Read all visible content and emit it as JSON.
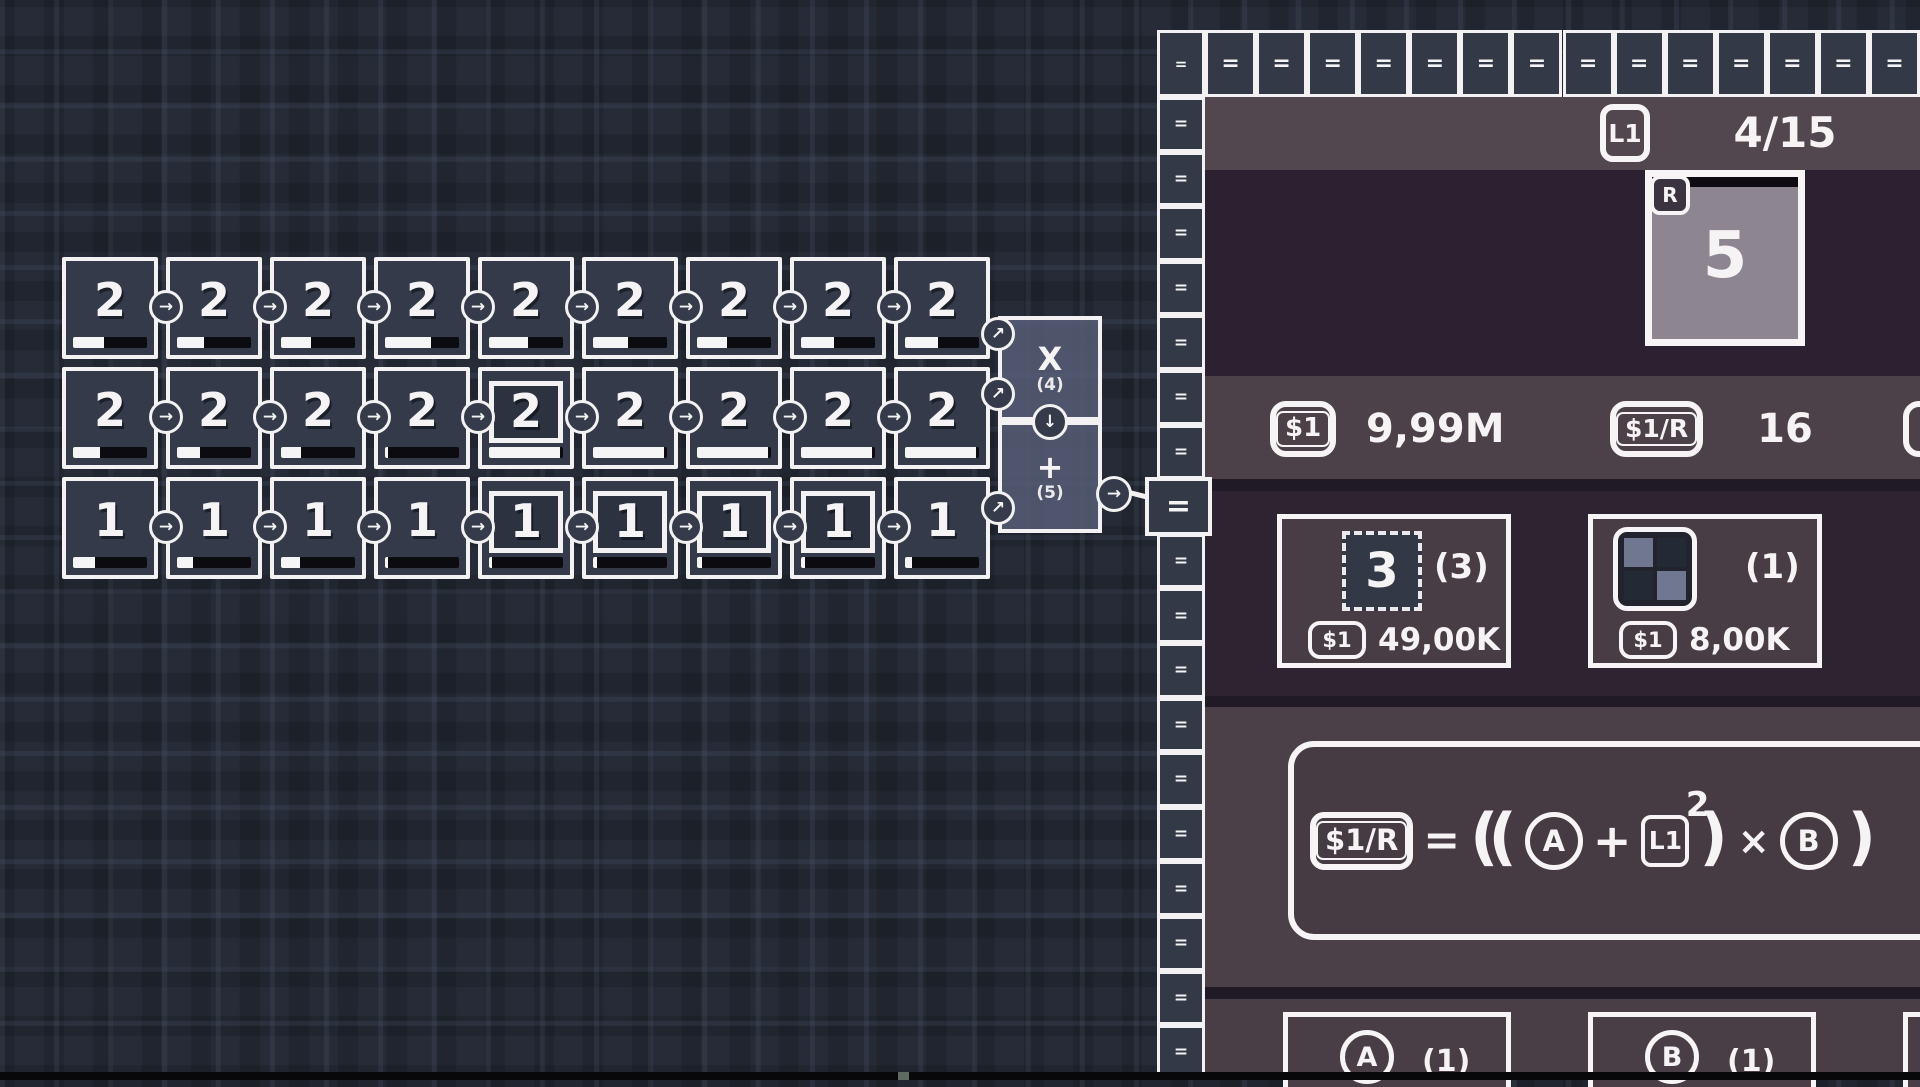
{
  "colors": {
    "canvas_bg": "#262b37",
    "cell_fill": "#343a49",
    "white": "#f5f3f4",
    "progress_track": "#0b0b10",
    "operator_fill": "#585f78",
    "panel_dark": "#2b2130",
    "panel_mauve": "#4d4149",
    "header_mauve": "#53474f",
    "separator": "#201a24",
    "shop_box_fill": "#483c45",
    "reward_card_fill": "#8d8590",
    "tile_fill": "#323845",
    "icon_light_square": "#6f7890",
    "icon_dark_square": "#242936"
  },
  "canvas": {
    "icons": {
      "right": "→",
      "diag": "↗",
      "down": "↓"
    },
    "grid": {
      "rows": [
        {
          "cells": [
            {
              "v": "2",
              "p": 42
            },
            {
              "v": "2",
              "p": 36
            },
            {
              "v": "2",
              "p": 41
            },
            {
              "v": "2",
              "p": 62
            },
            {
              "v": "2",
              "p": 53
            },
            {
              "v": "2",
              "p": 47
            },
            {
              "v": "2",
              "p": 41
            },
            {
              "v": "2",
              "p": 45
            },
            {
              "v": "2",
              "p": 44
            }
          ]
        },
        {
          "cells": [
            {
              "v": "2",
              "p": 36
            },
            {
              "v": "2",
              "p": 31
            },
            {
              "v": "2",
              "p": 27
            },
            {
              "v": "2",
              "p": 4
            },
            {
              "v": "2",
              "p": 96,
              "sel": true
            },
            {
              "v": "2",
              "p": 96
            },
            {
              "v": "2",
              "p": 96
            },
            {
              "v": "2",
              "p": 96
            },
            {
              "v": "2",
              "p": 96
            }
          ]
        },
        {
          "cells": [
            {
              "v": "1",
              "p": 30
            },
            {
              "v": "1",
              "p": 22
            },
            {
              "v": "1",
              "p": 26
            },
            {
              "v": "1",
              "p": 4
            },
            {
              "v": "1",
              "p": 4,
              "sel": true
            },
            {
              "v": "1",
              "p": 5,
              "sel": true
            },
            {
              "v": "1",
              "p": 7,
              "sel": true
            },
            {
              "v": "1",
              "p": 6,
              "sel": true
            },
            {
              "v": "1",
              "p": 9
            }
          ]
        }
      ]
    },
    "operators": [
      {
        "symbol": "X",
        "count": "(4)"
      },
      {
        "symbol": "+",
        "count": "(5)"
      }
    ]
  },
  "panel": {
    "corner_glyph": "=",
    "top_strip": {
      "glyph": "=",
      "count": 14
    },
    "side_strip": {
      "glyph": "=",
      "count": 18,
      "big_index": 7
    },
    "header": {
      "level_badge": "L1",
      "counter": "4/15"
    },
    "reward_card": {
      "corner_badge": "R",
      "value": "5"
    },
    "currencies": [
      {
        "badge": "$1",
        "amount": "9,99M"
      },
      {
        "badge": "$1/R",
        "amount": "16"
      }
    ],
    "shop": [
      {
        "tile": "3",
        "owned": "(3)",
        "cost_badge": "$1",
        "cost": "49,00K"
      },
      {
        "owned": "(1)",
        "cost_badge": "$1",
        "cost": "8,00K"
      }
    ],
    "formula": {
      "lhs": "$1/R",
      "eq": "=",
      "open": "((",
      "a": "A",
      "plus": "+",
      "lvl": "L1",
      "exp": "2",
      "close1": ")",
      "times": "×",
      "b": "B",
      "close2": ")"
    },
    "variables": [
      {
        "label": "A",
        "owned": "(1)"
      },
      {
        "label": "B",
        "owned": "(1)"
      }
    ]
  }
}
